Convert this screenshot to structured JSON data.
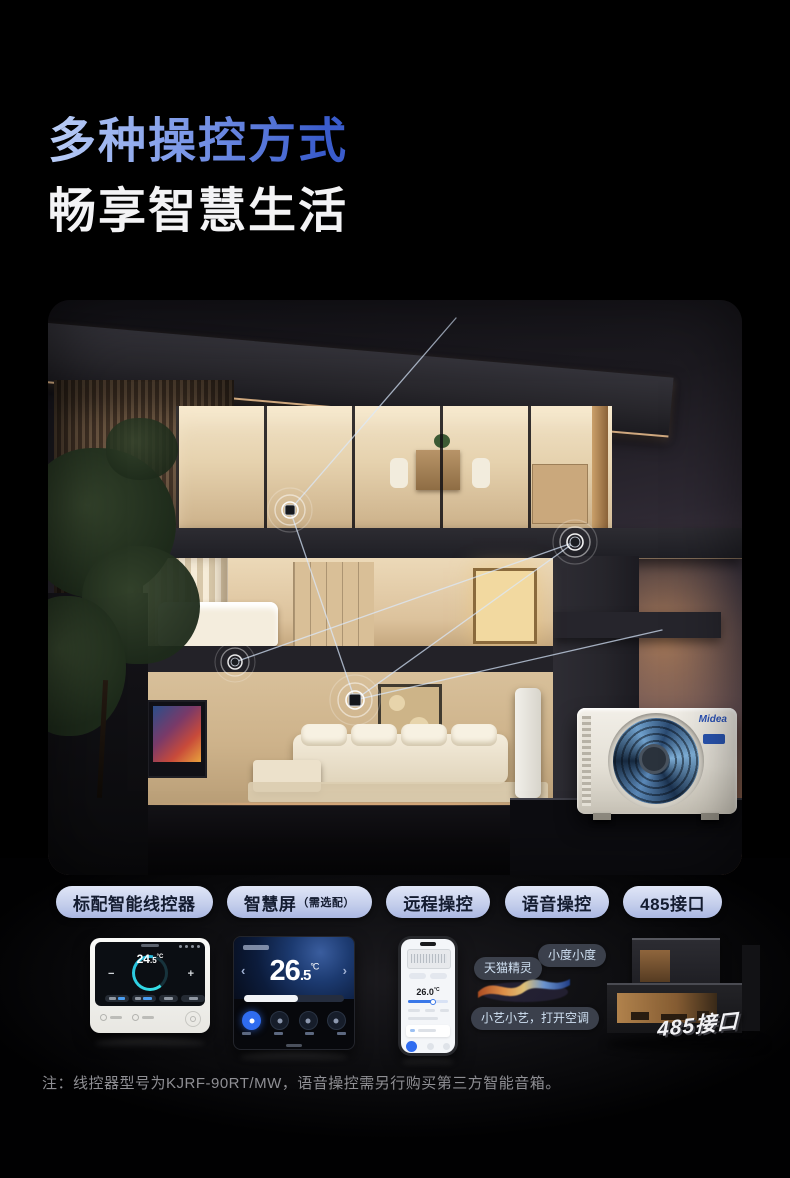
{
  "header": {
    "line1": "多种操控方式",
    "line2": "畅享智慧生活"
  },
  "badges": [
    {
      "label": "标配智能线控器"
    },
    {
      "label": "智慧屏",
      "small": "（需选配）"
    },
    {
      "label": "远程操控"
    },
    {
      "label": "语音操控"
    },
    {
      "label": "485接口"
    }
  ],
  "controller": {
    "temp_main": "24",
    "temp_frac": ".5",
    "temp_unit": "°C",
    "minus": "−",
    "plus": "+"
  },
  "smart_screen": {
    "temp_main": "26",
    "temp_frac": ".5",
    "temp_unit": "°C",
    "prev": "‹",
    "next": "›"
  },
  "phone": {
    "temp": "26.0",
    "temp_unit": "°C"
  },
  "voice": {
    "bubble_left": "天猫精灵",
    "bubble_right": "小度小度",
    "bubble_bottom": "小艺小艺，打开空调"
  },
  "model_house": {
    "label": "485接口"
  },
  "outdoor_unit": {
    "brand": "Midea"
  },
  "footnote": "注：线控器型号为KJRF-90RT/MW，语音操控需另行购买第三方智能音箱。",
  "colors": {
    "title_gradient_start": "#bdd0f7",
    "title_gradient_end": "#3a5ccc",
    "badge_bg": "#c3cdeb",
    "badge_text": "#141c30",
    "accent_blue": "#2f6cf0",
    "sunset": "#c8885a"
  }
}
